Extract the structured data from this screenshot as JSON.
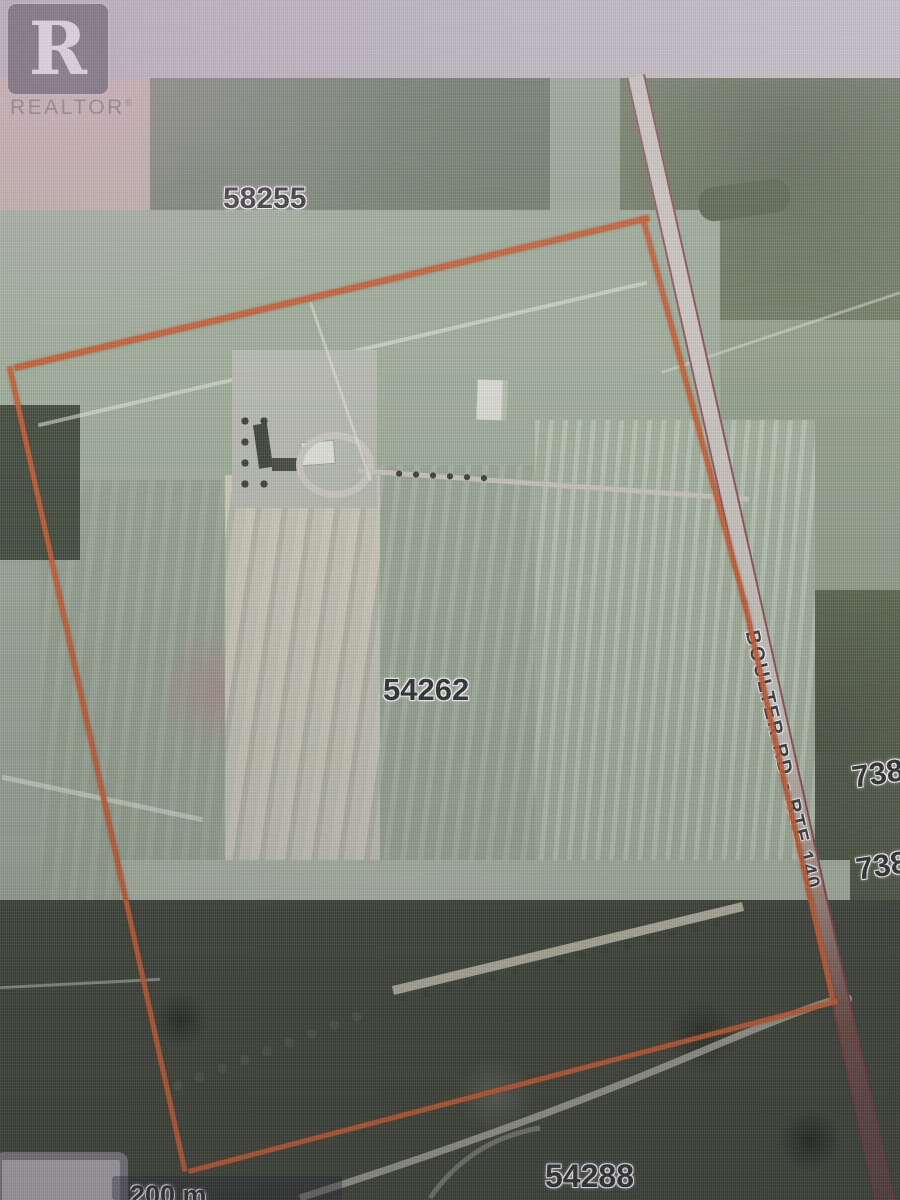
{
  "branding": {
    "logo_letter": "R",
    "logo_text": "REALTOR",
    "registered_mark": "®"
  },
  "map": {
    "parcels": {
      "north": "58255",
      "subject": "54262",
      "south": "54288",
      "east_partial_top": "738",
      "east_partial_bottom": "738"
    },
    "road": {
      "label": "BOULTER RD - RTE 140"
    },
    "scale": {
      "label": "200 m"
    },
    "colors": {
      "boundary": "#c65c31",
      "road_edge": "#7c3340",
      "road_surface": "#c8c3bc",
      "forest": "#3e4438",
      "field_sage": "#9aa794",
      "field_light": "#c6c3b2",
      "plowed_pink": "#bfaaa5"
    }
  }
}
